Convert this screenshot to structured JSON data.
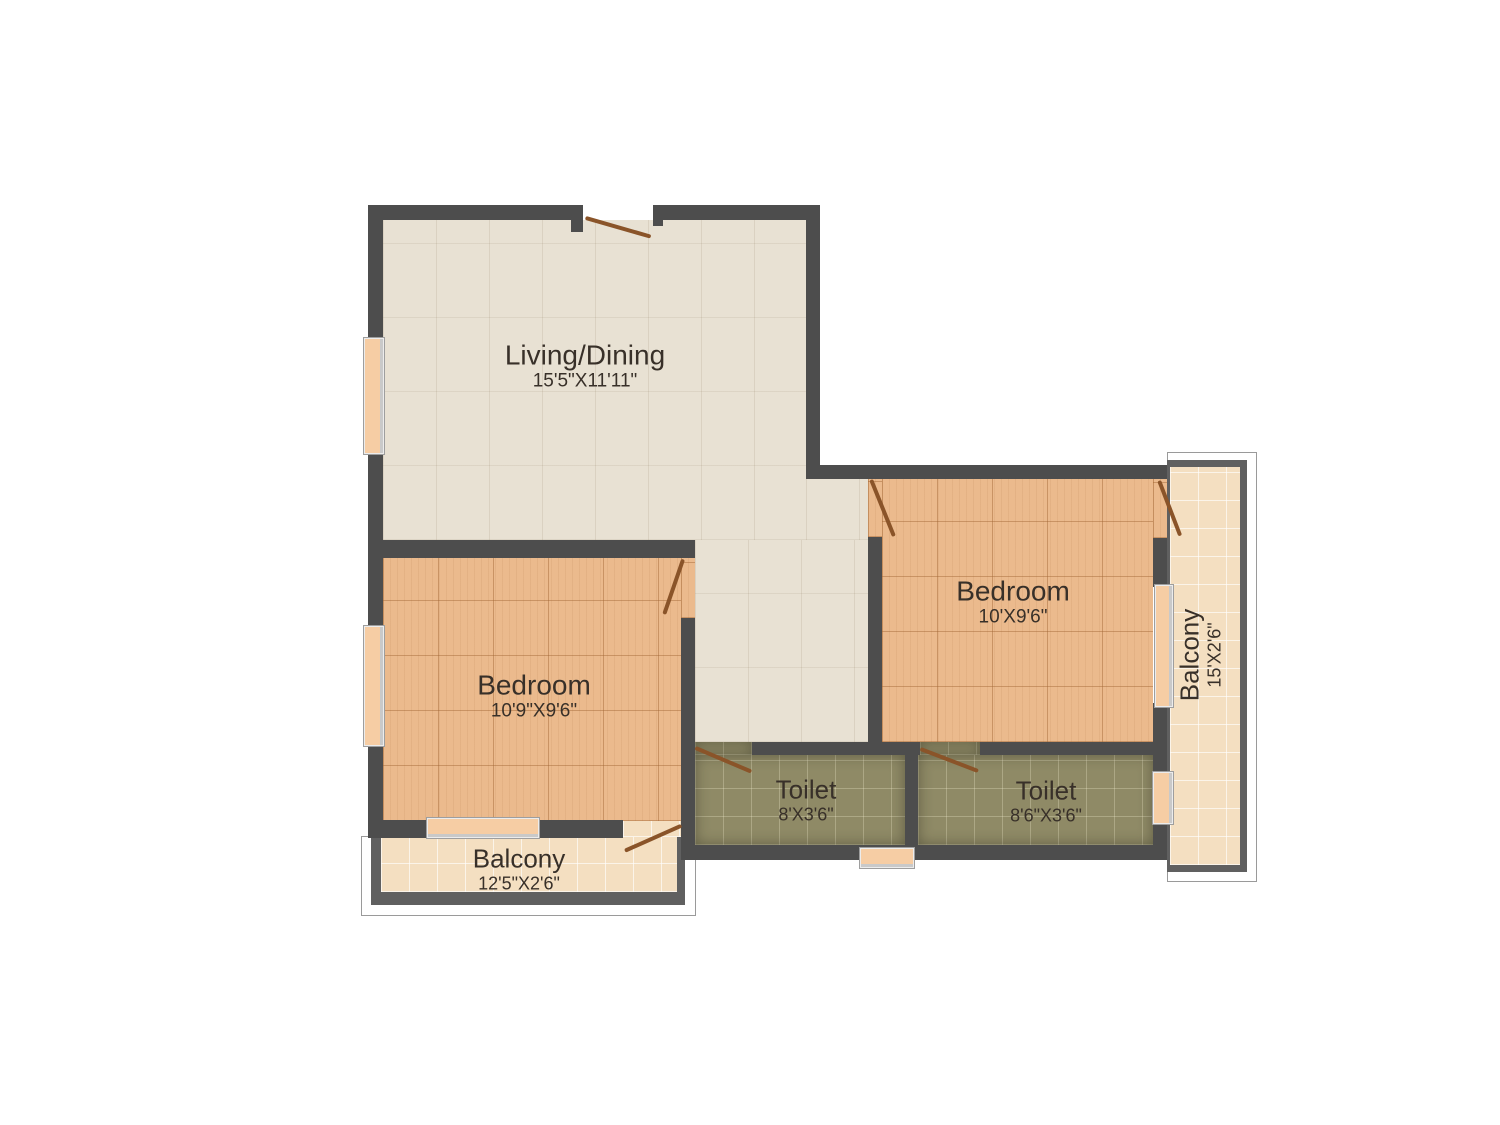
{
  "colors": {
    "wall": "#4d4d4d",
    "floor_living": "#e8e1d3",
    "floor_wood": "#ebba8d",
    "floor_toilet": "#8f8a66",
    "floor_balcony": "#f4dfc1",
    "door": "#8a5429",
    "window_fill": "#f6cda4",
    "railing_gray": "#606060",
    "text": "#383029"
  },
  "rooms": {
    "living": {
      "name": "Living/Dining",
      "dims": "15'5\"X11'11\""
    },
    "bedroom_left": {
      "name": "Bedroom",
      "dims": "10'9\"X9'6\""
    },
    "bedroom_right": {
      "name": "Bedroom",
      "dims": "10'X9'6\""
    },
    "toilet_left": {
      "name": "Toilet",
      "dims": "8'X3'6\""
    },
    "toilet_right": {
      "name": "Toilet",
      "dims": "8'6\"X3'6\""
    },
    "balcony_bottom": {
      "name": "Balcony",
      "dims": "12'5\"X2'6\""
    },
    "balcony_right": {
      "name": "Balcony",
      "dims": "15'X2'6\""
    }
  }
}
